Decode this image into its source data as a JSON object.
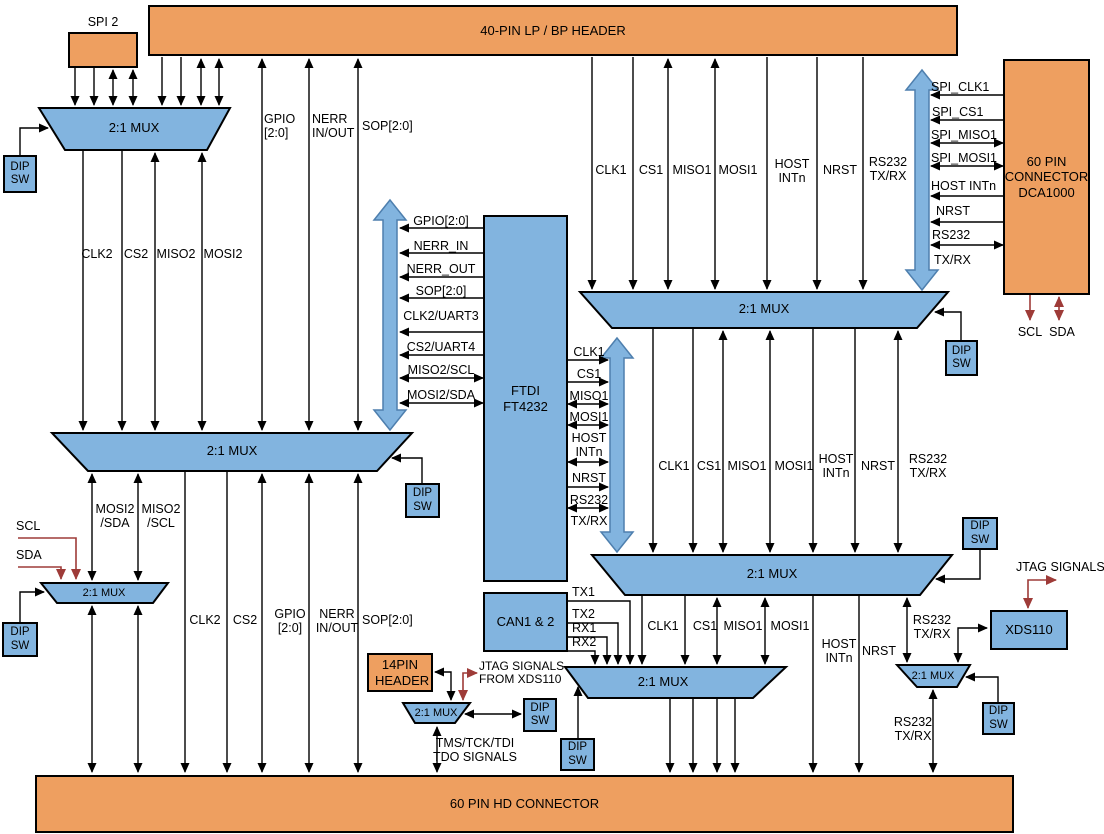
{
  "colors": {
    "orange": "#EE9F60",
    "blue": "#82B4DF",
    "arrow": "#4E7FAE",
    "red": "#9E3B38",
    "line": "#000000",
    "bg": "#FFFFFF"
  },
  "blocks": {
    "spi2": "SPI 2",
    "lp_header": "40-PIN LP / BP HEADER",
    "dca1000": "60 PIN CONNECTOR DCA1000",
    "ftdi": "FTDI FT4232",
    "can": "CAN1 & 2",
    "header14": "14PIN HEADER",
    "xds110": "XDS110",
    "hd_connector": "60 PIN HD CONNECTOR",
    "mux": "2:1 MUX",
    "dip_sw": "DIP SW"
  },
  "signals": {
    "clk1": "CLK1",
    "cs1": "CS1",
    "miso1": "MISO1",
    "mosi1": "MOSI1",
    "clk2": "CLK2",
    "cs2": "CS2",
    "miso2": "MISO2",
    "mosi2": "MOSI2",
    "host_intn": "HOST INTn",
    "nrst": "NRST",
    "rs232_txrx": "RS232 TX/RX",
    "rs232": "RS232",
    "txrx": "TX/RX",
    "gpio": "GPIO [2:0]",
    "gpio_c": "GPIO[2:0]",
    "sop": "SOP[2:0]",
    "nerr_inout": "NERR IN/OUT",
    "nerr_in": "NERR_IN",
    "nerr_out": "NERR_OUT",
    "clk2_uart3": "CLK2/UART3",
    "cs2_uart4": "CS2/UART4",
    "miso2_scl": "MISO2/SCL",
    "mosi2_sda": "MOSI2/SDA",
    "miso2_scl_col": "MISO2 /SCL",
    "mosi2_sda_col": "MOSI2 /SDA",
    "scl": "SCL",
    "sda": "SDA",
    "spi_clk1": "SPI_CLK1",
    "spi_cs1": "SPI_CS1",
    "spi_miso1": "SPI_MISO1",
    "spi_mosi1": "SPI_MOSI1",
    "tx1": "TX1",
    "tx2": "TX2",
    "rx1": "RX1",
    "rx2": "RX2",
    "jtag_from_xds110": "JTAG SIGNALS FROM XDS110",
    "tms_tck_tdi_tdo": "TMS/TCK/TDI TDO SIGNALS",
    "jtag_signals": "JTAG SIGNALS"
  }
}
